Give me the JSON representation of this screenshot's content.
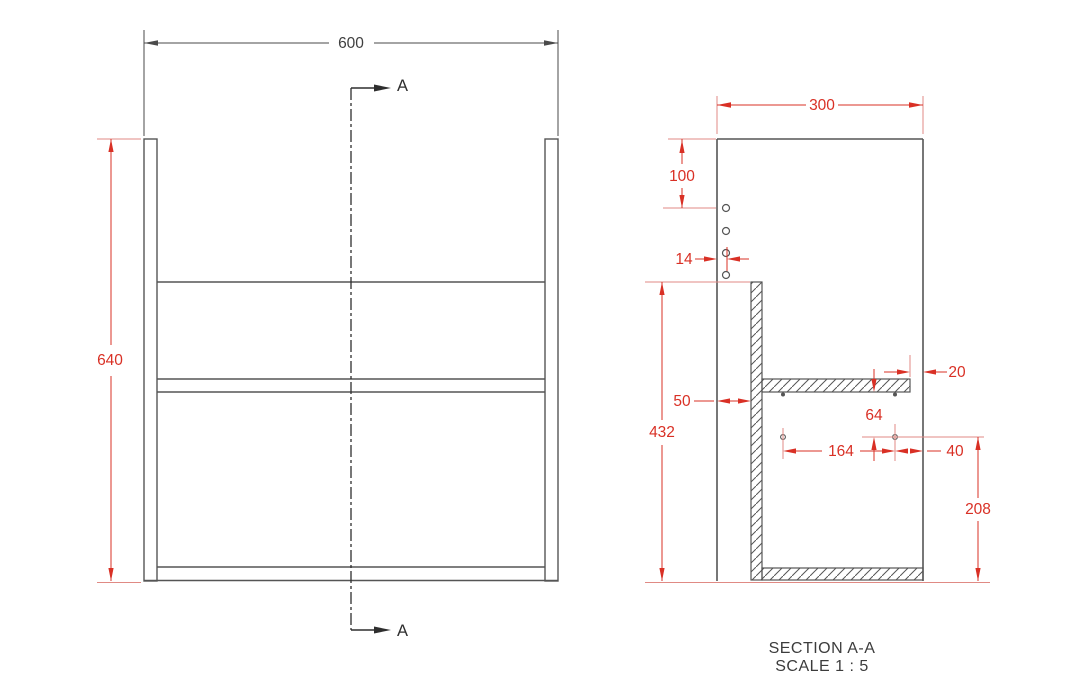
{
  "title": {
    "section": "SECTION A-A",
    "scale": "SCALE 1 : 5"
  },
  "front_view": {
    "width": "600",
    "height": "640",
    "cut_label": "A"
  },
  "section_view": {
    "depth": "300",
    "first_hole_from_top": "100",
    "hole_edge_inset": "14",
    "front_gap": "50",
    "back_panel_height": "432",
    "shelf_back_gap": "20",
    "shelf_to_pin_row": "64",
    "pin_spacing": "164",
    "pin_to_back": "40",
    "pin_row_height": "208"
  },
  "colors": {
    "line_gray": "#555555",
    "dimension_red": "#d93025",
    "text_dark": "#3c3c3c",
    "background": "#ffffff"
  }
}
